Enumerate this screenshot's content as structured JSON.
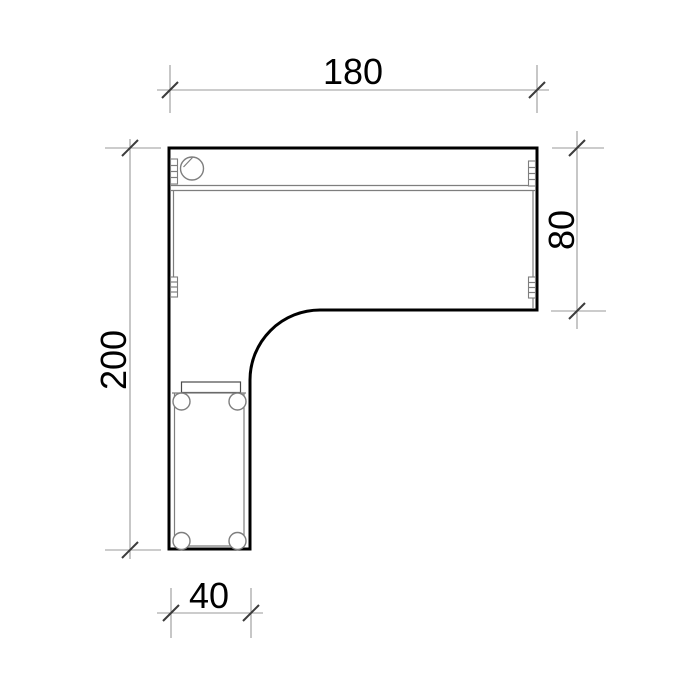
{
  "drawing": {
    "type": "technical-plan-l-shaped-desk-top-view",
    "dimensions": {
      "top": {
        "value": "180",
        "side": "top",
        "orientation": "horizontal"
      },
      "right": {
        "value": "80",
        "side": "right",
        "orientation": "vertical"
      },
      "left": {
        "value": "200",
        "side": "left",
        "orientation": "vertical"
      },
      "bottom": {
        "value": "40",
        "side": "bottom",
        "orientation": "horizontal"
      }
    },
    "features": {
      "grommet_holes": 1,
      "edge_fittings": 4,
      "screw_holes": 4,
      "back_panel_double_line": true,
      "inner_corner_radius": true
    },
    "colors": {
      "bg": "#ffffff",
      "outline": "#000000",
      "thin": "#7e7e7e",
      "dim": "#999999",
      "tick": "#3c3c3c",
      "text": "#000000"
    }
  }
}
